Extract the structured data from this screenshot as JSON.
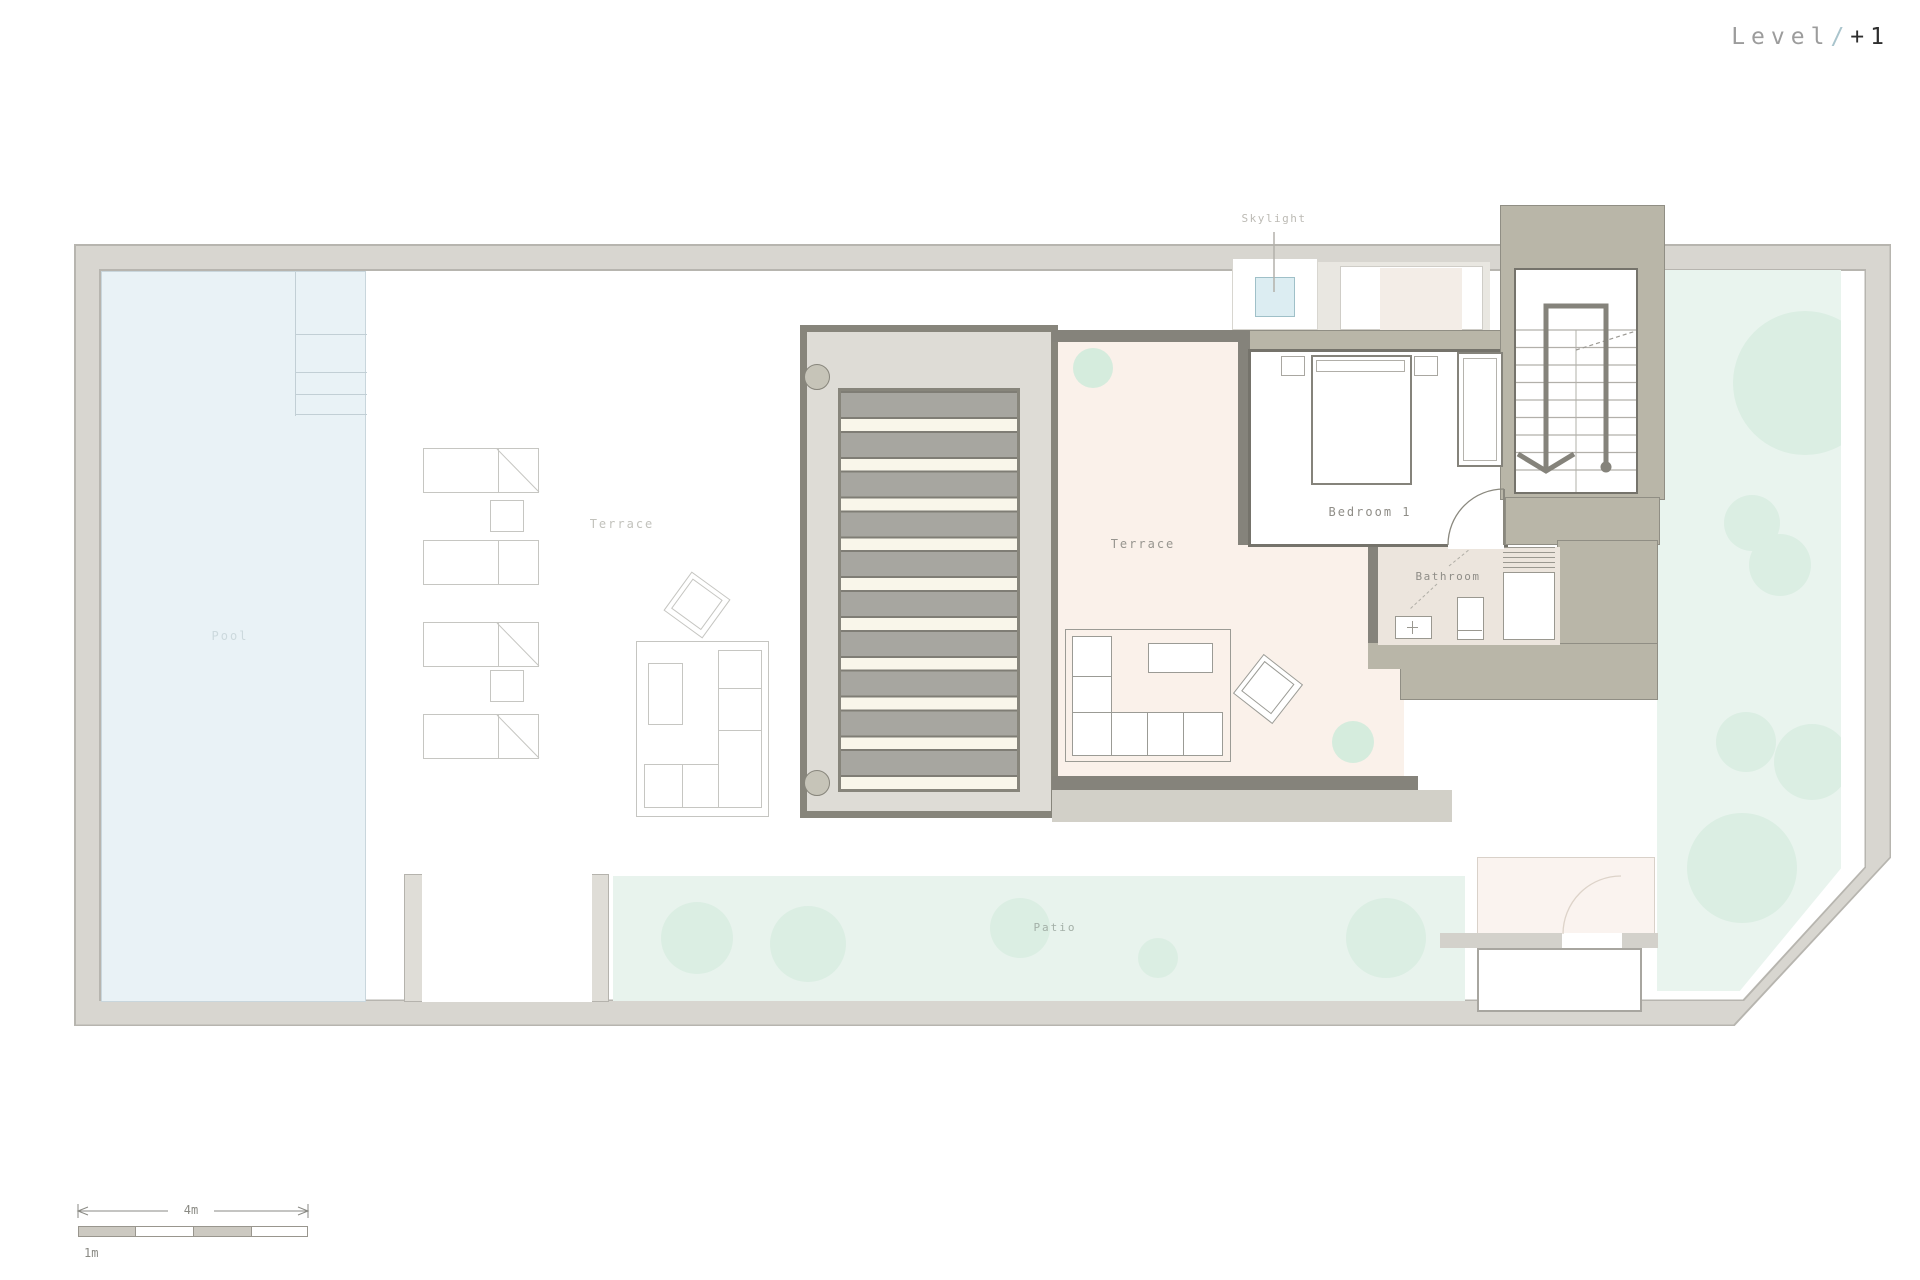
{
  "header": {
    "level_word": "Level",
    "separator": "/",
    "number": "+1"
  },
  "rooms": {
    "pool": "Pool",
    "terrace_outdoor": "Terrace",
    "terrace_indoor": "Terrace",
    "bedroom": "Bedroom 1",
    "bathroom": "Bathroom",
    "patio": "Patio"
  },
  "annotations": {
    "skylight": "Skylight"
  },
  "scale_bar": {
    "total": "4m",
    "unit": "1m"
  },
  "colors": {
    "boundary_wall": "#d8d6d0",
    "building_wall_band": "#b9b6a8",
    "wall_line": "#85837b",
    "pool_water": "#e9f2f6",
    "garden_green": "#e9f4ee",
    "tree_green": "#dbeee3",
    "terrace_floor": "#faf1ea",
    "bathroom_floor": "#ece5dd",
    "pergola_deck": "#dedcd6",
    "slat_gray": "#a7a6a0",
    "slat_gap_cream": "#f9f6ea",
    "skylight_blue": "#dcedf2",
    "title_accent": "#a9c4cc"
  }
}
